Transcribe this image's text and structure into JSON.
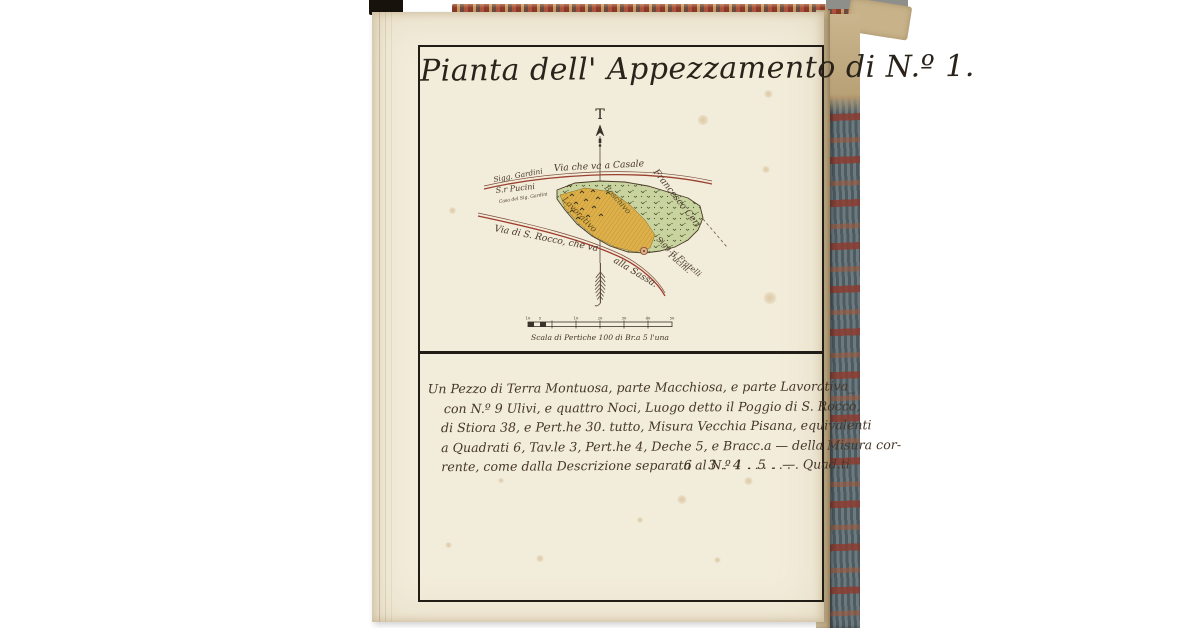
{
  "doc": {
    "title": "Pianta dell' Appezzamento di N.º 1.",
    "compass": {
      "north_letter": "T"
    },
    "map": {
      "road_top_label": "Via che va a Casale",
      "neighbor_right_label": "Francesco Ceri",
      "owner_left_line1": "Sigg. Gardini",
      "owner_left_line2": "S.r Pucini",
      "owner_left_line3": "Casa del Sig. Gardini",
      "landuse_arable_label": "Lavorativo",
      "landuse_woodland_label": "Boschivo",
      "road_bottom_label_1": "Via di S. Rocco, che va",
      "road_bottom_label_2": "alla Sassa.",
      "neighbor_bottom_label_1": "Sigg.ri Fratelli",
      "neighbor_bottom_label_2": "Pucini.",
      "colors": {
        "woodland_fill": "#c9d3a0",
        "arable_fill": "#ddb04a",
        "road_ink": "#9a4030",
        "outline_ink": "#4a3a26"
      }
    },
    "scale_bar": {
      "tick_labels": [
        "10",
        "5",
        "10",
        "20",
        "30",
        "40",
        "50"
      ],
      "caption": "Scala di Pertiche 100 di Br.a 5 l'una"
    },
    "description": {
      "lines": [
        "Un Pezzo di Terra Montuosa, parte Macchiosa, e parte Lavorativa_",
        "con N.º 9 Ulivi, e quattro Noci, Luogo detto il Poggio di S. Rocco,",
        "di Stiora 38, e Pert.he 30. tutto, Misura Vecchia Pisana, equivalenti",
        "a Quadrati 6, Tav.le 3, Pert.he 4, Deche 5, e Bracc.a — della Misura cor-",
        "rente, come dalla Descrizione separata al N.º 1 . . . . . . . Quad.ti"
      ],
      "total": "6 . 3 . 4 . 5 . —"
    }
  }
}
